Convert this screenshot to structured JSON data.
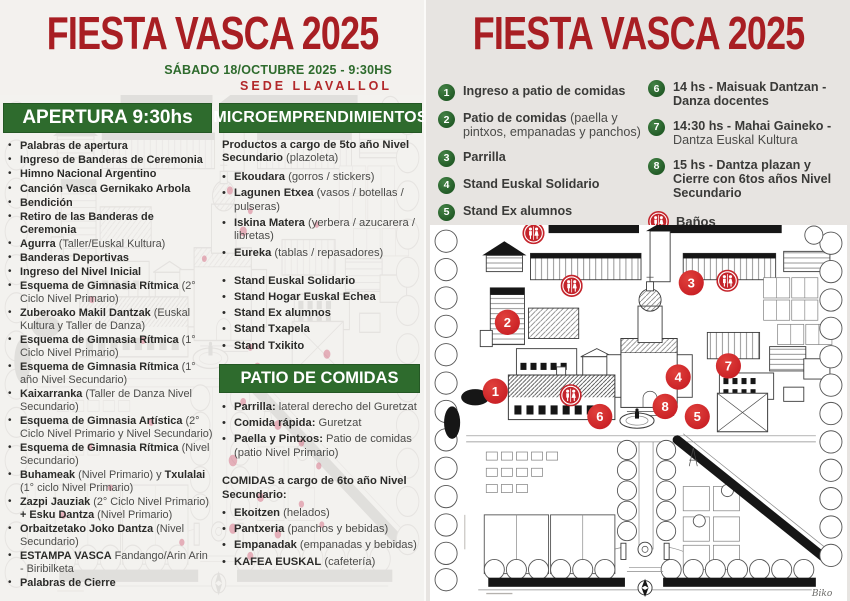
{
  "colors": {
    "title_red": "#a81e23",
    "header_green": "#2e6b2d",
    "badge_green": "#245d28",
    "marker_red": "#d7282e",
    "banos_red": "#c4242b"
  },
  "left_page": {
    "title": "FIESTA VASCA 2025",
    "subtitle": "SÁBADO 18/OCTUBRE 2025 - 9:30HS",
    "venue": "SEDE LLAVALLOL",
    "apertura": {
      "header": "APERTURA 9:30hs",
      "items": [
        [
          [
            "Palabras de apertura",
            1
          ]
        ],
        [
          [
            "Ingreso de Banderas de Ceremonia",
            1
          ]
        ],
        [
          [
            "Himno Nacional Argentino",
            1
          ]
        ],
        [
          [
            "Canción Vasca Gernikako Arbola",
            1
          ]
        ],
        [
          [
            "Bendición",
            1
          ]
        ],
        [
          [
            "Retiro de las Banderas de Ceremonia",
            1
          ]
        ],
        [
          [
            "Agurra",
            1
          ],
          [
            " (Taller/Euskal Kultura)",
            0
          ]
        ],
        [
          [
            "Banderas Deportivas",
            1
          ]
        ],
        [
          [
            "Ingreso del Nivel Inicial",
            1
          ]
        ],
        [
          [
            "Esquema de Gimnasia Rítmica",
            1
          ],
          [
            " (2° Ciclo Nivel Primario)",
            0
          ]
        ],
        [
          [
            "Zuberoako Makil Dantzak",
            1
          ],
          [
            " (Euskal Kultura y Taller de Danza)",
            0
          ]
        ],
        [
          [
            "Esquema de Gimnasia Rítmica",
            1
          ],
          [
            " (1° Ciclo Nivel Primario)",
            0
          ]
        ],
        [
          [
            "Esquema de Gimnasia Rítmica",
            1
          ],
          [
            " (1° año Nivel Secundario)",
            0
          ]
        ],
        [
          [
            "Kaixarranka",
            1
          ],
          [
            " (Taller de Danza Nivel Secundario)",
            0
          ]
        ],
        [
          [
            "Esquema de Gimnasia Artística",
            1
          ],
          [
            " (2° Ciclo Nivel Primario y Nivel Secundario)",
            0
          ]
        ],
        [
          [
            "Esquema de Gimnasia Rítmica",
            1
          ],
          [
            " (Nivel Secundario)",
            0
          ]
        ],
        [
          [
            "Buhameak",
            1
          ],
          [
            " (Nivel Primario) y ",
            0
          ],
          [
            "Txulalai",
            1
          ],
          [
            " (1° ciclo Nivel Primario)",
            0
          ]
        ],
        [
          [
            "Zazpi Jauziak",
            1
          ],
          [
            " (2° Ciclo Nivel Primario) ",
            0
          ],
          [
            "+ Esku Dantza",
            1
          ],
          [
            " (Nivel Primario)",
            0
          ]
        ],
        [
          [
            "Orbaitzetako Joko Dantza",
            1
          ],
          [
            " (Nivel Secundario)",
            0
          ]
        ],
        [
          [
            "ESTAMPA VASCA",
            1
          ],
          [
            " Fandango/Arin Arin - Biribilketa",
            0
          ]
        ],
        [
          [
            "Palabras de Cierre",
            1
          ]
        ]
      ]
    },
    "micro": {
      "header": "MICROEMPRENDIMIENTOS",
      "intro": [
        [
          "Productos a cargo de 5to año Nivel Secundario ",
          1
        ],
        [
          "(plazoleta)",
          0
        ]
      ],
      "products": [
        [
          [
            "Ekoudara",
            1
          ],
          [
            " (gorros / stickers)",
            0
          ]
        ],
        [
          [
            "Lagunen Etxea",
            1
          ],
          [
            " (vasos / botellas / pulseras)",
            0
          ]
        ],
        [
          [
            "Iskina Matera",
            1
          ],
          [
            " (yerbera / azucarera / libretas)",
            0
          ]
        ],
        [
          [
            "Eureka",
            1
          ],
          [
            " (tablas / repasadores)",
            0
          ]
        ]
      ],
      "stands": [
        [
          [
            "Stand Euskal Solidario",
            1
          ]
        ],
        [
          [
            "Stand Hogar Euskal Echea",
            1
          ]
        ],
        [
          [
            "Stand Ex alumnos",
            1
          ]
        ],
        [
          [
            "Stand Txapela",
            1
          ]
        ],
        [
          [
            "Stand Txikito",
            1
          ]
        ]
      ]
    },
    "patio": {
      "header": "PATIO DE COMIDAS",
      "items": [
        [
          [
            "Parrilla:",
            1
          ],
          [
            " lateral derecho del Guretzat",
            0
          ]
        ],
        [
          [
            "Comida rápida:",
            1
          ],
          [
            " Guretzat",
            0
          ]
        ],
        [
          [
            "Paella y Pintxos:",
            1
          ],
          [
            " Patio de comidas (patio Nivel Primario)",
            0
          ]
        ]
      ],
      "comidas_heading": [
        [
          "COMIDAS a cargo de 6to año Nivel Secundario:",
          1
        ]
      ],
      "comidas_items": [
        [
          [
            "Ekoitzen",
            1
          ],
          [
            " (helados)",
            0
          ]
        ],
        [
          [
            "Pantxeria",
            1
          ],
          [
            " (panchos y bebidas)",
            0
          ]
        ],
        [
          [
            "Empanadak",
            1
          ],
          [
            " (empanadas y bebidas)",
            0
          ]
        ],
        [
          [
            "KAFEA EUSKAL",
            1
          ],
          [
            " (cafetería)",
            0
          ]
        ]
      ]
    }
  },
  "right_page": {
    "title": "FIESTA VASCA 2025",
    "legend_col1": [
      {
        "n": "1",
        "segs": [
          [
            "Ingreso a patio de comidas",
            1
          ]
        ]
      },
      {
        "n": "2",
        "segs": [
          [
            "Patio de comidas",
            1
          ],
          [
            " (paella y pintxos, empanadas y panchos)",
            0
          ]
        ]
      },
      {
        "n": "3",
        "segs": [
          [
            "Parrilla",
            1
          ]
        ]
      },
      {
        "n": "4",
        "segs": [
          [
            "Stand Euskal Solidario",
            1
          ]
        ]
      },
      {
        "n": "5",
        "segs": [
          [
            "Stand Ex alumnos",
            1
          ]
        ]
      }
    ],
    "legend_col2": [
      {
        "n": "6",
        "segs": [
          [
            "14 hs - Maisuak Dantzan - Danza docentes",
            1
          ]
        ]
      },
      {
        "n": "7",
        "segs": [
          [
            "14:30 hs - Mahai Gaineko - ",
            1
          ],
          [
            "Dantza Euskal Kultura",
            0
          ]
        ]
      },
      {
        "n": "8",
        "segs": [
          [
            "15 hs - Dantza plazan y Cierre con 6tos años Nivel Secundario",
            1
          ]
        ]
      }
    ],
    "banos_label": "Baños",
    "map": {
      "markers": [
        {
          "n": "1",
          "x": 65,
          "y": 164
        },
        {
          "n": "2",
          "x": 77,
          "y": 96
        },
        {
          "n": "3",
          "x": 260,
          "y": 57
        },
        {
          "n": "4",
          "x": 247,
          "y": 150
        },
        {
          "n": "5",
          "x": 266,
          "y": 189
        },
        {
          "n": "6",
          "x": 169,
          "y": 189
        },
        {
          "n": "7",
          "x": 297,
          "y": 139
        },
        {
          "n": "8",
          "x": 234,
          "y": 179
        }
      ],
      "banos_positions": [
        {
          "x": 103,
          "y": 8
        },
        {
          "x": 141,
          "y": 60
        },
        {
          "x": 296,
          "y": 55
        },
        {
          "x": 140,
          "y": 168
        }
      ],
      "signature": "Biko"
    }
  }
}
